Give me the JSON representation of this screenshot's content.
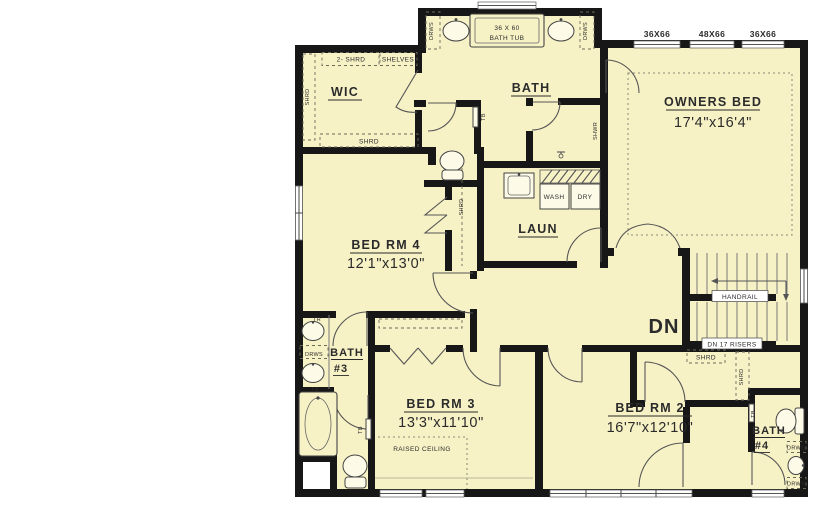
{
  "plan": {
    "colors": {
      "floor": "#f7f2c6",
      "wall": "#171717",
      "background": "#ffffff",
      "line": "#555555"
    },
    "rooms": {
      "wic": "WIC",
      "bath_owners": "BATH",
      "owners": {
        "name": "OWNERS BED",
        "dims": "17'4\"x16'4\""
      },
      "bed4": {
        "name": "BED RM 4",
        "dims": "12'1\"x13'0\""
      },
      "laundry": "LAUN",
      "bath3": {
        "name": "BATH",
        "num": "#3"
      },
      "bed3": {
        "name": "BED RM 3",
        "dims": "13'3\"x11'10\""
      },
      "bed2": {
        "name": "BED RM 2",
        "dims": "16'7\"x12'10\""
      },
      "bath4": {
        "name": "BATH",
        "num": "#4"
      }
    },
    "windows": {
      "w36": "36X66",
      "w48": "48X66"
    },
    "fixtures": {
      "tub_size": "36 X 60",
      "tub_name": "BATH TUB",
      "wash": "WASH",
      "dry": "DRY"
    },
    "stairs": {
      "handrail": "HANDRAIL",
      "dn": "DN",
      "risers": "DN 17 RISERS"
    },
    "notes": {
      "raised": "RAISED CEILING"
    },
    "tags": {
      "shrd": "SHRD",
      "shrd2": "2- SHRD",
      "shelves": "SHELVES",
      "drws": "DRWS",
      "tr": "TR",
      "tb": "TB",
      "shwr": "SHWR"
    }
  }
}
